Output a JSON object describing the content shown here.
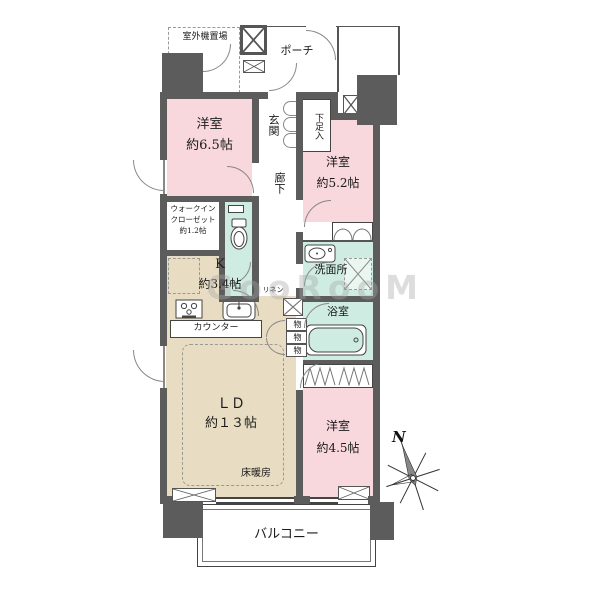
{
  "plan_title": "floor-plan",
  "watermark": "GooRooM",
  "compass_label": "N",
  "rooms": {
    "outdoor_unit": {
      "label": "室外機置場"
    },
    "porch": {
      "label": "ポーチ"
    },
    "entrance": {
      "label": "玄関"
    },
    "shoe_cabinet": {
      "label": "下足入"
    },
    "western_room_65": {
      "label": "洋室",
      "size": "約6.5帖"
    },
    "corridor": {
      "label": "廊下"
    },
    "western_room_52": {
      "label": "洋室",
      "size": "約5.2帖"
    },
    "walk_in_closet": {
      "line1": "ウォークイン",
      "line2": "クローゼット",
      "line3": "約1.2帖"
    },
    "kitchen": {
      "label": "K",
      "size": "約3.4帖"
    },
    "counter": {
      "label": "カウンター"
    },
    "linen": {
      "label": "リネン"
    },
    "washroom": {
      "label": "洗面所"
    },
    "bathroom": {
      "label": "浴室"
    },
    "storage_labels": [
      "物",
      "物",
      "物"
    ],
    "living_dining": {
      "label": "ＬＤ",
      "size": "約１３帖",
      "note": "床暖房"
    },
    "western_room_45": {
      "label": "洋室",
      "size": "約4.5帖"
    },
    "balcony": {
      "label": "バルコニー"
    }
  },
  "colors": {
    "room_pink": "#f8d7dd",
    "ldk_tan": "#e8ddc2",
    "wet_green": "#cfece2",
    "wall_gray": "#5c5c5c",
    "line_dark": "#444444"
  }
}
